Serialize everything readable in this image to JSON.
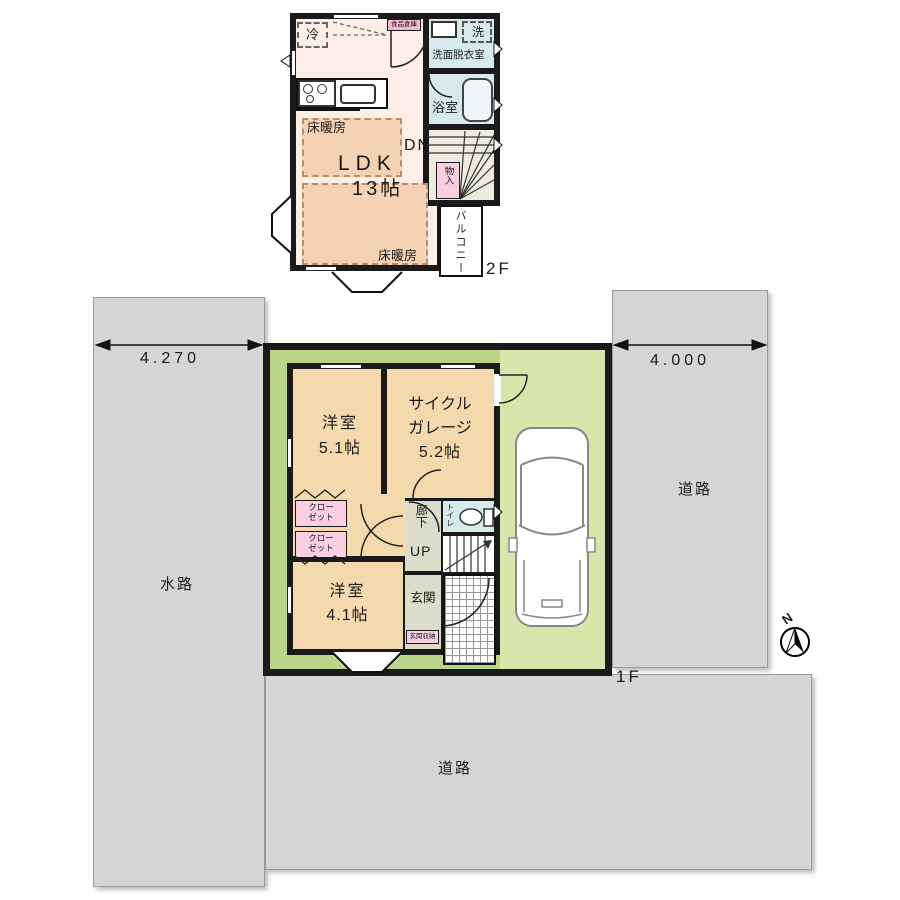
{
  "colors": {
    "wall": "#1a1a1a",
    "road_gray": "#d5d5d5",
    "lawn_green": "#b9d688",
    "driveway_green": "#d7e6ab",
    "room_tan": "#f4d9ad",
    "ldk_pink": "#fdeee7",
    "floor_heating_peach": "#f6d2b4",
    "closet_pink": "#f9cfe1",
    "wet_area_blue": "#d6eaec",
    "hall_gray": "#dcdcca",
    "stair_beige": "#ecebdc"
  },
  "floor2": {
    "floor_label": "2F",
    "ldk_label": "LDK",
    "ldk_size": "13帖",
    "floor_heating_label": "床暖房",
    "fridge_label": "冷",
    "pantry_label": "食品倉庫",
    "washer_label": "洗",
    "washroom_label": "洗面脱衣室",
    "bath_label": "浴室",
    "stairs_down_label": "DN",
    "storage_label": "物入",
    "balcony_label": "バルコニー"
  },
  "floor1": {
    "floor_label": "1F",
    "room1_label": "洋室",
    "room1_size": "5.1帖",
    "garage_label_line1": "サイクル",
    "garage_label_line2": "ガレージ",
    "garage_size": "5.2帖",
    "closet_line1": "クロー",
    "closet_line2": "ゼット",
    "room2_label": "洋室",
    "room2_size": "4.1帖",
    "hallway_label": "廊下",
    "stairs_up_label": "UP",
    "toilet_label": "トイレ",
    "entrance_label": "玄関",
    "entrance_storage_label": "玄関収納"
  },
  "site": {
    "waterway_label": "水路",
    "road_right_label": "道路",
    "road_bottom_label": "道路",
    "dim_left": "4.270",
    "dim_right": "4.000",
    "north_label": "N"
  }
}
